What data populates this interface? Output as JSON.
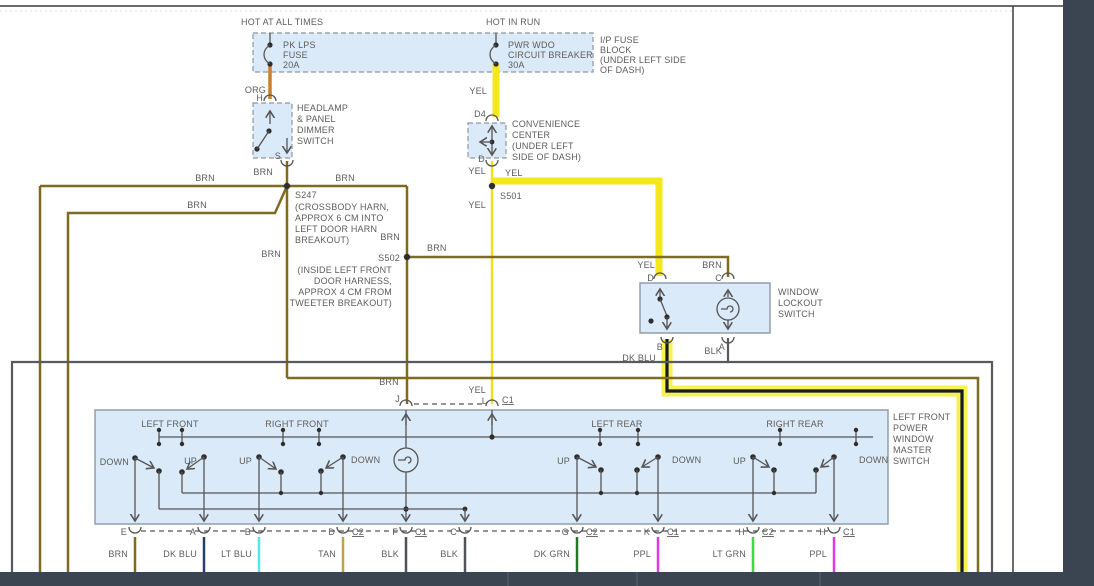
{
  "app": {
    "background": "#3b4552",
    "canvas": "#ffffff",
    "frame_color": "#3c3c3c"
  },
  "colors": {
    "box_fill": "#dbeaf8",
    "box_border": "#8d98a2",
    "text": "#5c5c5c",
    "brn": "#7f6a1f",
    "org": "#c8802d",
    "yel": "#f4e81c",
    "dk_blu": "#24406e",
    "lt_blu": "#57e6e6",
    "tan": "#bfa04f",
    "blk": "#565a5f",
    "dk_grn": "#1f7a21",
    "ppl": "#e23ae2",
    "lt_grn": "#3cdc3c",
    "highlight_halo": "#f7f13c",
    "highlight_core": "#141a26"
  },
  "header": {
    "hot_at_all_times": "HOT AT ALL TIMES",
    "hot_in_run": "HOT IN RUN"
  },
  "fuse_block": {
    "fuse_lines": [
      "PK LPS",
      "FUSE",
      "20A"
    ],
    "breaker_lines": [
      "PWR WDO",
      "CIRCUIT BREAKER",
      "30A"
    ],
    "block_lines": [
      "I/P FUSE",
      "BLOCK",
      "(UNDER LEFT SIDE",
      "OF DASH)"
    ]
  },
  "dimmer_switch": {
    "lines": [
      "HEADLAMP",
      "& PANEL",
      "DIMMER",
      "SWITCH"
    ],
    "pin_top": "H",
    "pin_bottom": "S"
  },
  "convenience_center": {
    "lines": [
      "CONVENIENCE",
      "CENTER",
      "(UNDER LEFT",
      "SIDE OF DASH)"
    ],
    "pin_top": "D4",
    "pin_bottom": "D"
  },
  "splices": {
    "s247": {
      "id": "S247",
      "lines": [
        "(CROSSBODY HARN,",
        "APPROX 6 CM INTO",
        "LEFT DOOR HARN",
        "BREAKOUT)"
      ]
    },
    "s501": {
      "id": "S501"
    },
    "s502": {
      "id": "S502",
      "lines": [
        "(INSIDE LEFT FRONT",
        "DOOR HARNESS,",
        "APPROX 4 CM FROM",
        "TWEETER BREAKOUT)"
      ]
    }
  },
  "wire_names": {
    "brn": "BRN",
    "yel": "YEL",
    "org": "ORG",
    "dk_blu": "DK BLU",
    "blk": "BLK",
    "lt_blu": "LT BLU",
    "tan": "TAN",
    "dk_grn": "DK GRN",
    "ppl": "PPL",
    "lt_grn": "LT GRN"
  },
  "lockout_switch": {
    "lines": [
      "WINDOW",
      "LOCKOUT",
      "SWITCH"
    ],
    "pin_d": "D",
    "pin_c": "C",
    "pin_b": "B",
    "pin_a": "A"
  },
  "master_switch": {
    "label_lines": [
      "LEFT FRONT",
      "POWER",
      "WINDOW",
      "MASTER",
      "SWITCH"
    ],
    "sections": [
      "LEFT FRONT",
      "RIGHT FRONT",
      "LEFT REAR",
      "RIGHT REAR"
    ],
    "sw": {
      "up": "UP",
      "down": "DOWN"
    },
    "top_pins": {
      "j": "J",
      "l": "L",
      "l_connector": "C1"
    },
    "bottom_pins": [
      {
        "pin": "E",
        "connector": "",
        "wire": "BRN"
      },
      {
        "pin": "A",
        "connector": "",
        "wire": "DK BLU"
      },
      {
        "pin": "B",
        "connector": "",
        "wire": "LT BLU"
      },
      {
        "pin": "D",
        "connector": "C2",
        "wire": "TAN"
      },
      {
        "pin": "F",
        "connector": "C1",
        "wire": "BLK"
      },
      {
        "pin": "C",
        "connector": "",
        "wire": "BLK"
      },
      {
        "pin": "G",
        "connector": "C2",
        "wire": "DK GRN"
      },
      {
        "pin": "K",
        "connector": "C1",
        "wire": "PPL"
      },
      {
        "pin": "H",
        "connector": "C2",
        "wire": "LT GRN"
      },
      {
        "pin": "H",
        "connector": "C1",
        "wire": "PPL"
      }
    ]
  }
}
